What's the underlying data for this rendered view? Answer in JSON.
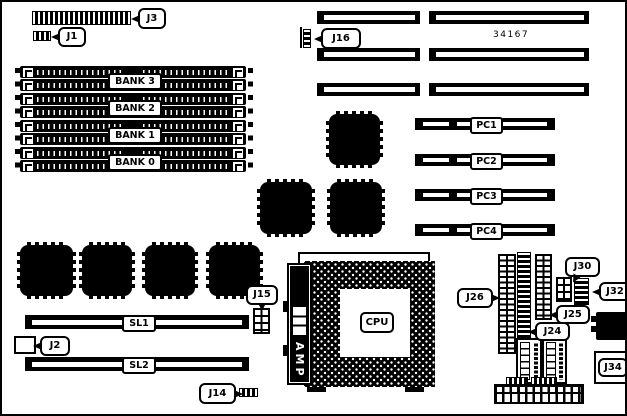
{
  "diagram": {
    "type": "motherboard-layout",
    "board_number": "34167"
  },
  "labels": {
    "j1": "J1",
    "j2": "J2",
    "j3": "J3",
    "j14": "J14",
    "j15": "J15",
    "j16": "J16",
    "j24": "J24",
    "j25": "J25",
    "j26": "J26",
    "j30": "J30",
    "j32": "J32",
    "j34": "J34",
    "bank0": "BANK 0",
    "bank1": "BANK 1",
    "bank2": "BANK 2",
    "bank3": "BANK 3",
    "pc1": "PC1",
    "pc2": "PC2",
    "pc3": "PC3",
    "pc4": "PC4",
    "sl1": "SL1",
    "sl2": "SL2",
    "cpu": "CPU",
    "amp": "AMP"
  }
}
